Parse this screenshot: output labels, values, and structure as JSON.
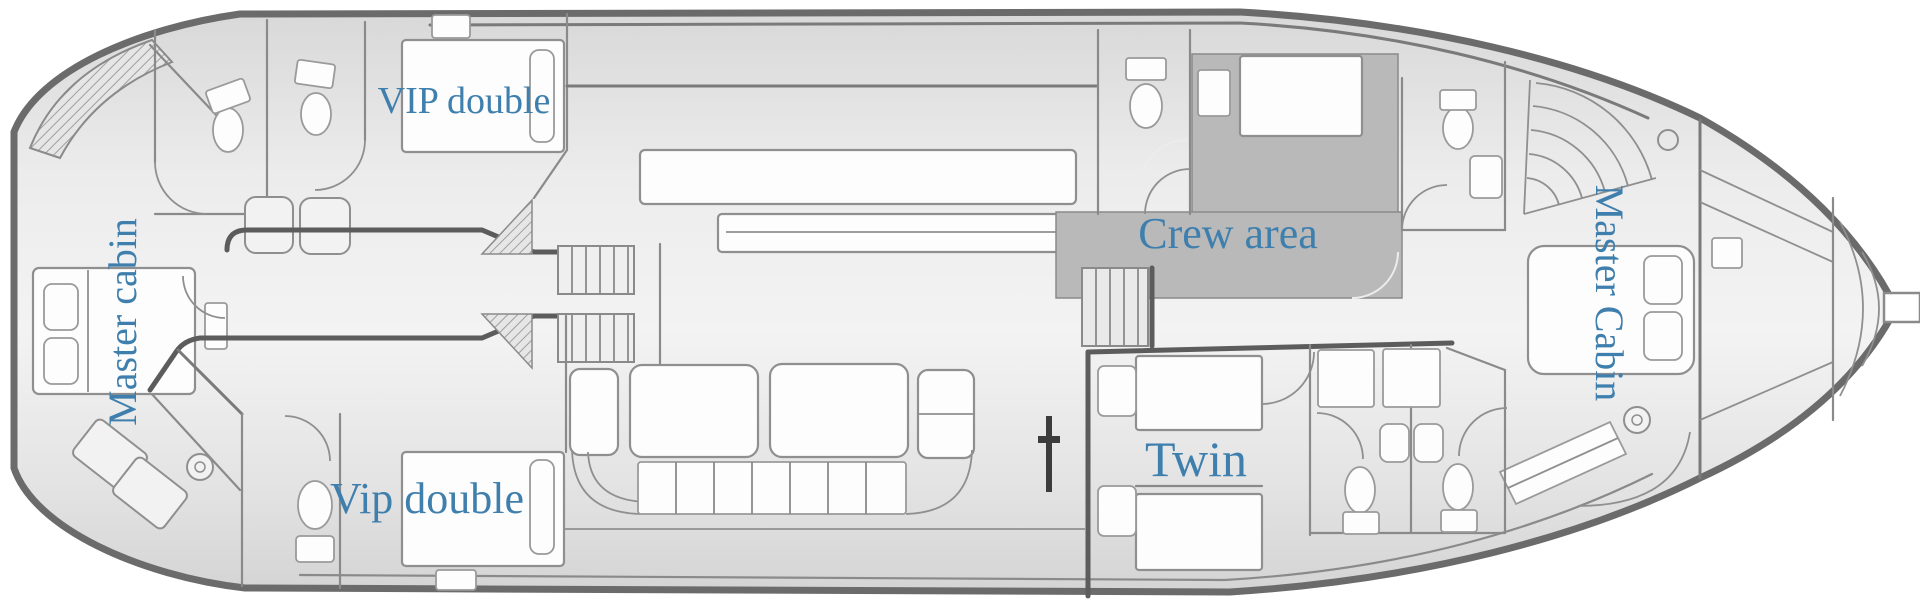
{
  "labels": {
    "vip_double_top": "VIP double",
    "master_cabin_left": "Master cabin",
    "crew_area": "Crew area",
    "twin": "Twin",
    "vip_double_bottom": "Vip double",
    "master_cabin_right": "Master Cabin"
  },
  "colors": {
    "label_text": "#3f7fad",
    "hull_outline": "#6b6b6b",
    "wall": "#8a8a8a",
    "heavy_wall": "#5c5c5c",
    "crew_area_fill": "#b9b9b9",
    "furniture_fill": "#fdfdfd",
    "deck_fill_light": "#f2f2f2",
    "deck_fill_dark": "#d6d6d6"
  },
  "icons": {
    "toilet": "toilet-icon",
    "sink": "sink-icon",
    "bed": "bed-icon",
    "stairs": "stairs-icon",
    "stool": "stool-icon",
    "mast": "mast-icon"
  }
}
